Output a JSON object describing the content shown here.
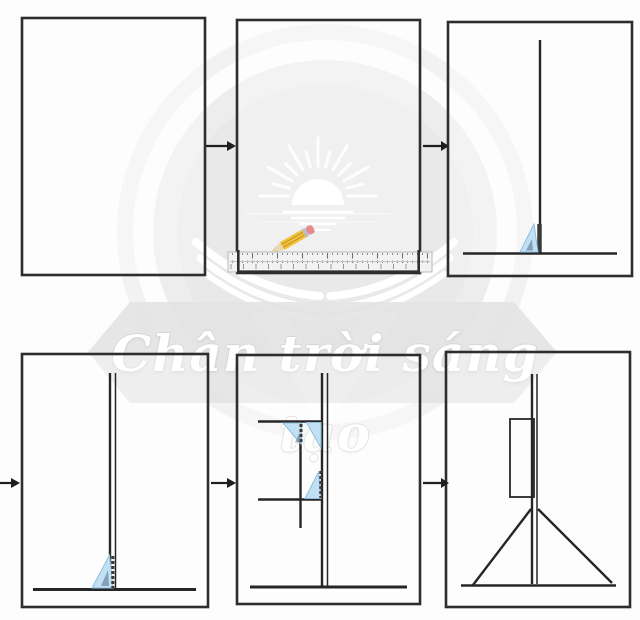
{
  "watermark": {
    "text": "Chân trời sáng tạo",
    "logo_icon": "sunrise-open-book-logo"
  },
  "steps": [
    {
      "index": 1,
      "icon": "blank-paper-icon"
    },
    {
      "index": 2,
      "icon": "ruler-and-pencil-icon"
    },
    {
      "index": 3,
      "icon": "set-square-vertical-line-icon"
    },
    {
      "index": 4,
      "icon": "double-fold-vertical-line-icon"
    },
    {
      "index": 5,
      "icon": "set-squares-perpendicular-crossbars-icon"
    },
    {
      "index": 6,
      "icon": "finished-easel-stand-icon"
    }
  ],
  "flow_arrows": [
    "arrow-step1-to-step2",
    "arrow-step2-to-step3",
    "arrow-into-step4",
    "arrow-step4-to-step5",
    "arrow-step5-to-step6"
  ],
  "colors": {
    "page_bg": "#fdfdfd",
    "panel_border": "#2e2e2e",
    "draw_line": "#262626",
    "arrow_color": "#1f1f1f",
    "set_square_fill": "#c2e0f3",
    "set_square_edge": "#8fbfdd",
    "pencil_body": "#f1c33d",
    "pencil_eraser": "#e8898d",
    "ruler_fill": "#f2f2f2",
    "watermark_disc": "#ededed",
    "watermark_band": "#e3e3e3",
    "watermark_text": "#ffffff"
  }
}
